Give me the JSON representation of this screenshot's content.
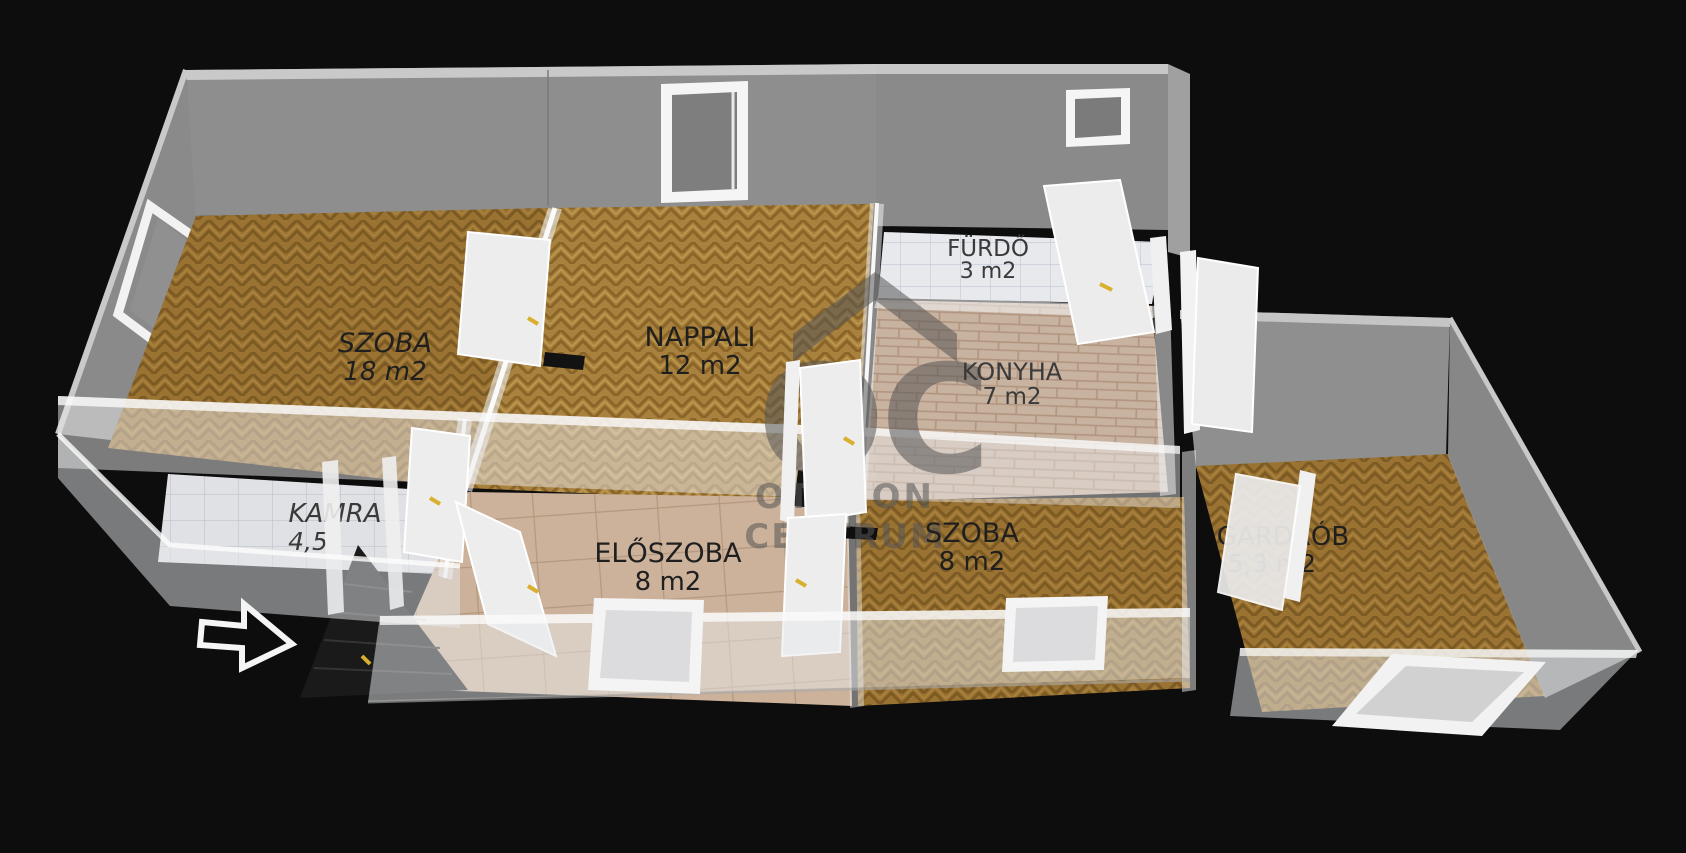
{
  "branding": {
    "logo_monogram": "OC",
    "logo_line1": "OTTHON",
    "logo_line2": "CENTRUM"
  },
  "rooms": [
    {
      "name": "SZOBA",
      "area": "18 m2"
    },
    {
      "name": "NAPPALI",
      "area": "12 m2"
    },
    {
      "name": "FÜRDŐ",
      "area": "3 m2"
    },
    {
      "name": "KONYHA",
      "area": "7 m2"
    },
    {
      "name": "KAMRA",
      "area": "4,5"
    },
    {
      "name": "ELŐSZOBA",
      "area": "8 m2"
    },
    {
      "name": "SZOBA",
      "area": "8 m2"
    },
    {
      "name": "GARDRÓB",
      "area": "5,3 m2"
    }
  ],
  "colors": {
    "background": "#0d0d0d",
    "wall_gray": "#8e8e8e",
    "wall_cap": "#c9c9c9",
    "parquet_brown": "#9a7231",
    "parquet_gold": "#a8813e",
    "tile_white": "#e8e9ec",
    "tile_beige": "#ccb29a",
    "brick_tile": "#c8b2a0",
    "door_white": "#ededed",
    "handle_yellow": "#d9b02e",
    "watermark_gray": "#565656",
    "arrow_white": "#f5f5f5",
    "label_dark": "#1f1f1f"
  }
}
